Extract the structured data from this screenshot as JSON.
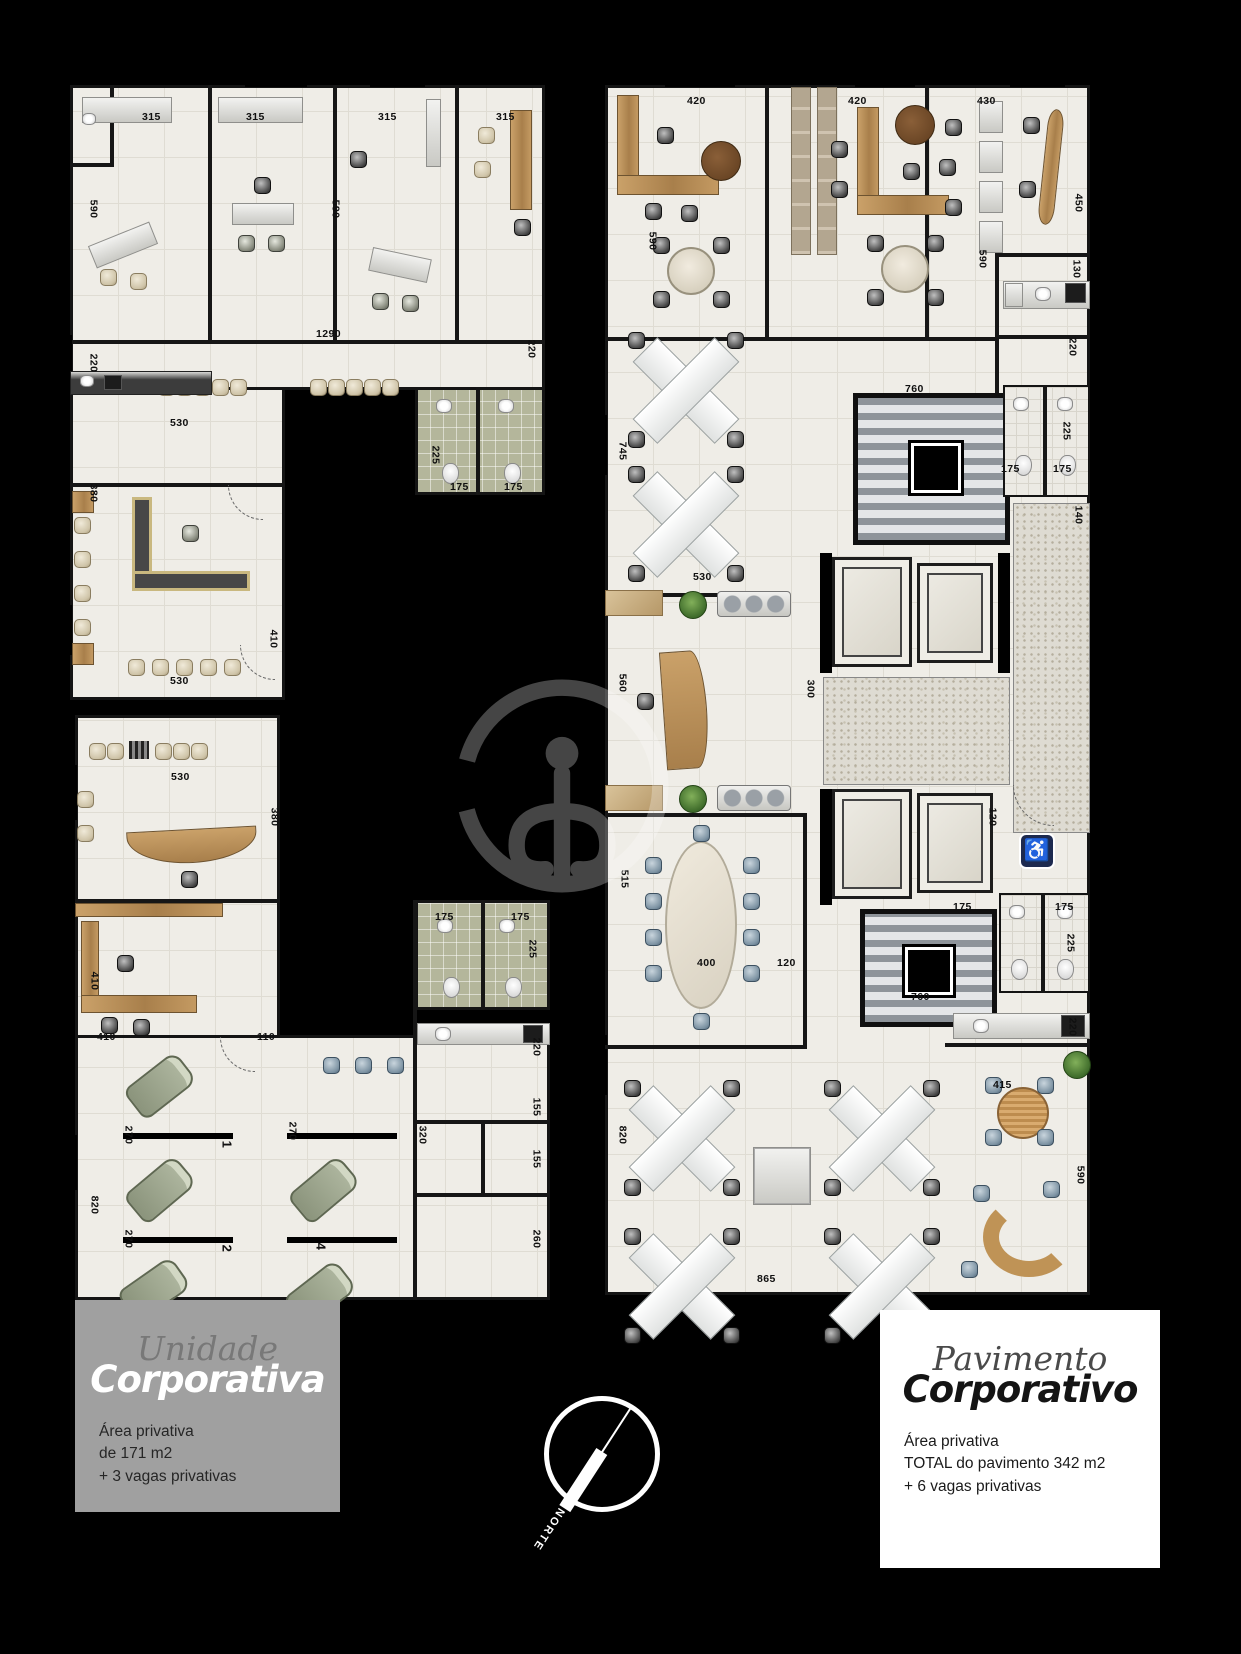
{
  "colors": {
    "background": "#000000",
    "floor": "#efede7",
    "bath_tile": "#b4b69b",
    "wood": "#b98a52",
    "box_gray": "#a0a0a0",
    "box_white": "#ffffff",
    "wc_sign": "#1d2a4f"
  },
  "icons": {
    "wheelchair": "♿"
  },
  "compass": {
    "label": "NORTE"
  },
  "left_unit": {
    "title_light": "Unidade",
    "title_bold": "Corporativa",
    "area_lines": [
      "Área privativa",
      "de 171 m2",
      "+ 3 vagas privativas"
    ]
  },
  "right_unit": {
    "title_light": "Pavimento",
    "title_bold": "Corporativo",
    "area_lines": [
      "Área privativa",
      "TOTAL do pavimento 342 m2",
      "+ 6 vagas privativas"
    ]
  },
  "plan_a": {
    "dims": [
      {
        "t": "315",
        "x": 72,
        "y": 26
      },
      {
        "t": "315",
        "x": 176,
        "y": 26
      },
      {
        "t": "315",
        "x": 308,
        "y": 26
      },
      {
        "t": "315",
        "x": 426,
        "y": 26
      },
      {
        "t": "590",
        "x": 14,
        "y": 118,
        "cls": "v"
      },
      {
        "t": "590",
        "x": 256,
        "y": 118,
        "cls": "v"
      },
      {
        "t": "1290",
        "x": 246,
        "y": 243
      },
      {
        "t": "220",
        "x": 14,
        "y": 272,
        "cls": "v"
      },
      {
        "t": "220",
        "x": 452,
        "y": 258,
        "cls": "v"
      },
      {
        "t": "530",
        "x": 100,
        "y": 332
      },
      {
        "t": "225",
        "x": 356,
        "y": 364,
        "cls": "v"
      },
      {
        "t": "175",
        "x": 380,
        "y": 396
      },
      {
        "t": "175",
        "x": 434,
        "y": 396
      },
      {
        "t": "380",
        "x": 14,
        "y": 402,
        "cls": "v"
      },
      {
        "t": "410",
        "x": 194,
        "y": 548,
        "cls": "v"
      },
      {
        "t": "530",
        "x": 100,
        "y": 590
      }
    ]
  },
  "plan_b": {
    "dims": [
      {
        "t": "530",
        "x": 96,
        "y": 66
      },
      {
        "t": "380",
        "x": 190,
        "y": 106,
        "cls": "v"
      },
      {
        "t": "410",
        "x": 10,
        "y": 270,
        "cls": "v"
      },
      {
        "t": "410",
        "x": 22,
        "y": 326
      },
      {
        "t": "110",
        "x": 182,
        "y": 326
      },
      {
        "t": "175",
        "x": 360,
        "y": 206
      },
      {
        "t": "175",
        "x": 436,
        "y": 206
      },
      {
        "t": "225",
        "x": 448,
        "y": 238,
        "cls": "v"
      },
      {
        "t": "220",
        "x": 452,
        "y": 336,
        "cls": "v"
      },
      {
        "t": "155",
        "x": 452,
        "y": 396,
        "cls": "v"
      },
      {
        "t": "155",
        "x": 452,
        "y": 448,
        "cls": "v"
      },
      {
        "t": "260",
        "x": 452,
        "y": 528,
        "cls": "v"
      },
      {
        "t": "320",
        "x": 338,
        "y": 424,
        "cls": "v"
      },
      {
        "t": "270",
        "x": 44,
        "y": 424,
        "cls": "v"
      },
      {
        "t": "270",
        "x": 208,
        "y": 420,
        "cls": "v"
      },
      {
        "t": "270",
        "x": 44,
        "y": 528,
        "cls": "v"
      },
      {
        "t": "820",
        "x": 10,
        "y": 494,
        "cls": "v"
      },
      {
        "t": "260",
        "x": 34,
        "y": 616,
        "cls": "v"
      }
    ],
    "parking": [
      {
        "t": "1",
        "x": 148,
        "y": 432,
        "cls": "v"
      },
      {
        "t": "2",
        "x": 148,
        "y": 536,
        "cls": "v"
      },
      {
        "t": "3",
        "x": 142,
        "y": 634,
        "cls": "v"
      },
      {
        "t": "4",
        "x": 242,
        "y": 534,
        "cls": "v"
      },
      {
        "t": "5",
        "x": 238,
        "y": 634,
        "cls": "v"
      }
    ]
  },
  "plan_c": {
    "dims": [
      {
        "t": "420",
        "x": 82,
        "y": 10
      },
      {
        "t": "420",
        "x": 243,
        "y": 10
      },
      {
        "t": "430",
        "x": 372,
        "y": 10
      },
      {
        "t": "590",
        "x": 38,
        "y": 150,
        "cls": "v"
      },
      {
        "t": "590",
        "x": 368,
        "y": 168,
        "cls": "v"
      },
      {
        "t": "450",
        "x": 464,
        "y": 112,
        "cls": "v"
      },
      {
        "t": "130",
        "x": 462,
        "y": 178,
        "cls": "v"
      },
      {
        "t": "220",
        "x": 458,
        "y": 256,
        "cls": "v"
      },
      {
        "t": "760",
        "x": 300,
        "y": 298
      },
      {
        "t": "745",
        "x": 8,
        "y": 360,
        "cls": "v"
      },
      {
        "t": "225",
        "x": 452,
        "y": 340,
        "cls": "v"
      },
      {
        "t": "175",
        "x": 396,
        "y": 378
      },
      {
        "t": "175",
        "x": 448,
        "y": 378
      },
      {
        "t": "140",
        "x": 464,
        "y": 424,
        "cls": "v"
      },
      {
        "t": "530",
        "x": 88,
        "y": 486
      },
      {
        "t": "560",
        "x": 8,
        "y": 592,
        "cls": "v"
      },
      {
        "t": "300",
        "x": 196,
        "y": 598,
        "cls": "v"
      },
      {
        "t": "120",
        "x": 378,
        "y": 726,
        "cls": "v"
      },
      {
        "t": "515",
        "x": 10,
        "y": 788,
        "cls": "v"
      },
      {
        "t": "400",
        "x": 92,
        "y": 872
      },
      {
        "t": "120",
        "x": 172,
        "y": 872
      },
      {
        "t": "175",
        "x": 348,
        "y": 816
      },
      {
        "t": "175",
        "x": 450,
        "y": 816
      },
      {
        "t": "225",
        "x": 456,
        "y": 852,
        "cls": "v"
      },
      {
        "t": "760",
        "x": 306,
        "y": 906
      },
      {
        "t": "220",
        "x": 458,
        "y": 936,
        "cls": "v"
      },
      {
        "t": "415",
        "x": 388,
        "y": 994
      },
      {
        "t": "820",
        "x": 8,
        "y": 1044,
        "cls": "v"
      },
      {
        "t": "590",
        "x": 466,
        "y": 1084,
        "cls": "v"
      },
      {
        "t": "865",
        "x": 152,
        "y": 1188
      }
    ]
  }
}
